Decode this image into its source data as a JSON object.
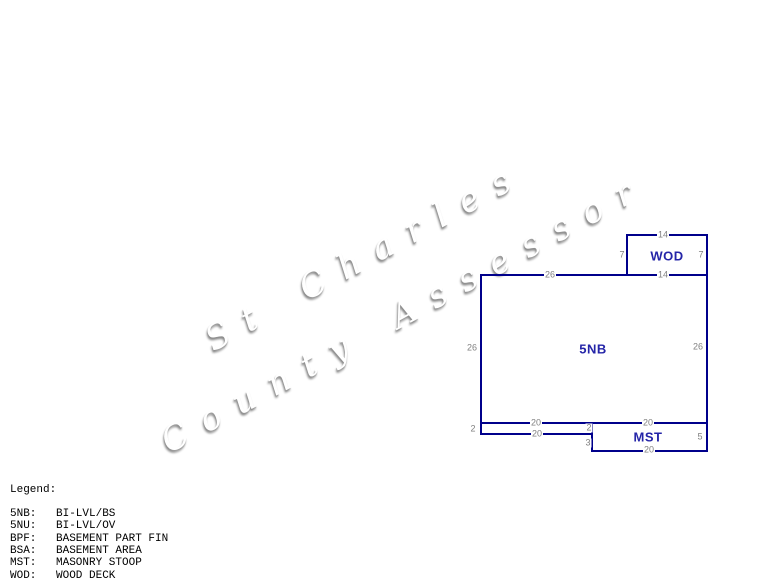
{
  "watermark": {
    "line1": "St Charles",
    "line2": "County Assessor"
  },
  "sketch": {
    "line_color": "#00008B",
    "area_label_color": "#2525a8",
    "dim_color": "#808080",
    "areas": [
      {
        "name": "wood-deck",
        "label": "WOD",
        "left": 626,
        "top": 234,
        "width": 82,
        "height": 42,
        "label_x": 667,
        "label_y": 256
      },
      {
        "name": "main-bi-level",
        "label": "5NB",
        "left": 480,
        "top": 274,
        "width": 228,
        "height": 150,
        "label_x": 593,
        "label_y": 349
      },
      {
        "name": "stoop-strip",
        "label": "",
        "left": 480,
        "top": 422,
        "width": 113,
        "height": 13,
        "label_x": 0,
        "label_y": 0
      },
      {
        "name": "masonry-stoop",
        "label": "MST",
        "left": 591,
        "top": 422,
        "width": 117,
        "height": 30,
        "label_x": 648,
        "label_y": 437
      }
    ],
    "dimensions": [
      {
        "text": "14",
        "x": 663,
        "y": 235
      },
      {
        "text": "7",
        "x": 622,
        "y": 255
      },
      {
        "text": "7",
        "x": 701,
        "y": 255
      },
      {
        "text": "14",
        "x": 663,
        "y": 275
      },
      {
        "text": "26",
        "x": 550,
        "y": 275
      },
      {
        "text": "26",
        "x": 472,
        "y": 348
      },
      {
        "text": "26",
        "x": 698,
        "y": 347
      },
      {
        "text": "20",
        "x": 536,
        "y": 423
      },
      {
        "text": "2",
        "x": 473,
        "y": 429
      },
      {
        "text": "20",
        "x": 537,
        "y": 434
      },
      {
        "text": "2",
        "x": 589,
        "y": 428
      },
      {
        "text": "3",
        "x": 588,
        "y": 443
      },
      {
        "text": "20",
        "x": 648,
        "y": 423
      },
      {
        "text": "5",
        "x": 700,
        "y": 437
      },
      {
        "text": "20",
        "x": 649,
        "y": 450
      }
    ]
  },
  "legend": {
    "title": "Legend:",
    "entries": [
      {
        "code": "5NB:",
        "desc": "BI-LVL/BS"
      },
      {
        "code": "5NU:",
        "desc": "BI-LVL/OV"
      },
      {
        "code": "BPF:",
        "desc": "BASEMENT PART FIN"
      },
      {
        "code": "BSA:",
        "desc": "BASEMENT AREA"
      },
      {
        "code": "MST:",
        "desc": "MASONRY STOOP"
      },
      {
        "code": "WOD:",
        "desc": "WOOD DECK"
      }
    ]
  }
}
